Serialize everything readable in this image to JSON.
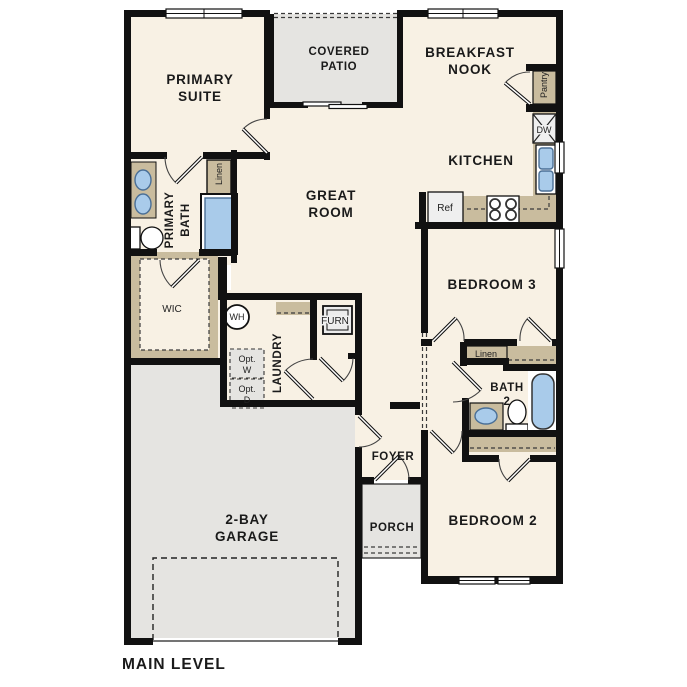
{
  "title": "MAIN LEVEL",
  "colors": {
    "floor": "#f8f1e4",
    "outdoor_gray": "#e5e4e1",
    "counter_tan": "#c9bc9e",
    "fixture_blue": "#a9cbea",
    "wall_black": "#111111"
  },
  "rooms": {
    "primary_suite": {
      "line1": "PRIMARY",
      "line2": "SUITE"
    },
    "covered_patio": {
      "line1": "COVERED",
      "line2": "PATIO"
    },
    "breakfast_nook": {
      "line1": "BREAKFAST",
      "line2": "NOOK"
    },
    "kitchen": {
      "label": "KITCHEN"
    },
    "great_room": {
      "line1": "GREAT",
      "line2": "ROOM"
    },
    "primary_bath": {
      "line1": "PRIMARY",
      "line2": "BATH"
    },
    "wic": {
      "label": "WIC"
    },
    "laundry": {
      "label": "LAUNDRY"
    },
    "foyer": {
      "label": "FOYER"
    },
    "porch": {
      "label": "PORCH"
    },
    "garage": {
      "line1": "2-BAY",
      "line2": "GARAGE"
    },
    "bedroom_3": {
      "label": "BEDROOM 3"
    },
    "bath_2": {
      "line1": "BATH",
      "line2": "2"
    },
    "bedroom_2": {
      "label": "BEDROOM 2"
    }
  },
  "fixtures": {
    "pantry": "Pantry",
    "dishwasher": "DW",
    "refrigerator": "Ref",
    "water_heater": "WH",
    "furnace": "FURN",
    "linen_primary": "Linen",
    "linen_bath": "Linen",
    "opt_washer": {
      "line1": "Opt.",
      "line2": "W"
    },
    "opt_dryer": {
      "line1": "Opt.",
      "line2": "D"
    }
  },
  "footer": {
    "label": "MAIN LEVEL"
  }
}
